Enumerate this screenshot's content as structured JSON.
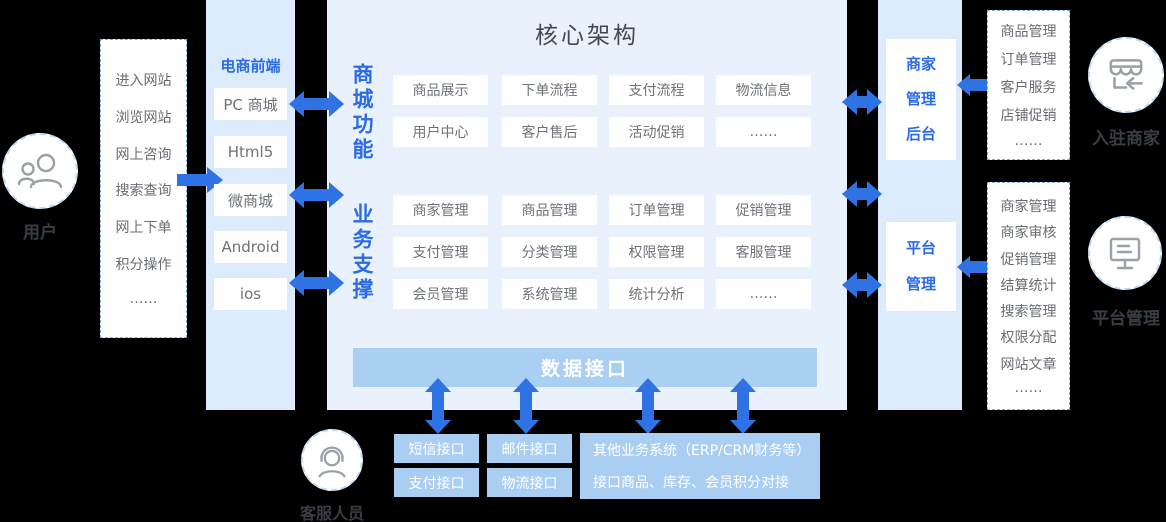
{
  "colors": {
    "accent_blue": "#2f72e3",
    "panel_blue": "#e8f1fc",
    "column_blue": "#dcebfb",
    "bar_blue": "#a9cff3",
    "interface_box_blue": "#a9cef2",
    "blue_text": "#2b6be4",
    "gray_text": "#6e7278",
    "dark_label": "#3a3d43"
  },
  "left": {
    "user_label": "用户",
    "actions": [
      "进入网站",
      "浏览网站",
      "网上咨询",
      "搜索查询",
      "网上下单",
      "积分操作",
      "……"
    ]
  },
  "frontend": {
    "label": "电商前端",
    "channels": [
      "PC 商城",
      "Html5",
      "微商城",
      "Android",
      "ios"
    ]
  },
  "core": {
    "title": "核心架构",
    "mall": {
      "label": "商城功能",
      "items": [
        "商品展示",
        "下单流程",
        "支付流程",
        "物流信息",
        "用户中心",
        "客户售后",
        "活动促销",
        "……"
      ]
    },
    "biz": {
      "label": "业务支撑",
      "items": [
        "商家管理",
        "商品管理",
        "订单管理",
        "促销管理",
        "支付管理",
        "分类管理",
        "权限管理",
        "客服管理",
        "会员管理",
        "系统管理",
        "统计分析",
        "……"
      ]
    },
    "data_interface": "数据接口"
  },
  "interfaces": {
    "boxes": [
      "短信接口",
      "邮件接口",
      "支付接口",
      "物流接口"
    ],
    "other": {
      "line1": "其他业务系统（ERP/CRM财务等）",
      "line2": "接口商品、库存、会员积分对接"
    }
  },
  "service": {
    "label": "客服人员"
  },
  "right": {
    "merchant_admin": "商家\n管理\n后台",
    "platform_admin": "平台\n管理",
    "merchant": {
      "items": [
        "商品管理",
        "订单管理",
        "客户服务",
        "店铺促销",
        "……"
      ],
      "label": "入驻商家"
    },
    "platform": {
      "items": [
        "商家管理",
        "商家审核",
        "促销管理",
        "结算统计",
        "搜索管理",
        "权限分配",
        "网站文章",
        "……"
      ],
      "label": "平台管理"
    }
  },
  "icons": [
    "user-icon",
    "headset-icon",
    "storefront-icon",
    "monitor-icon"
  ]
}
